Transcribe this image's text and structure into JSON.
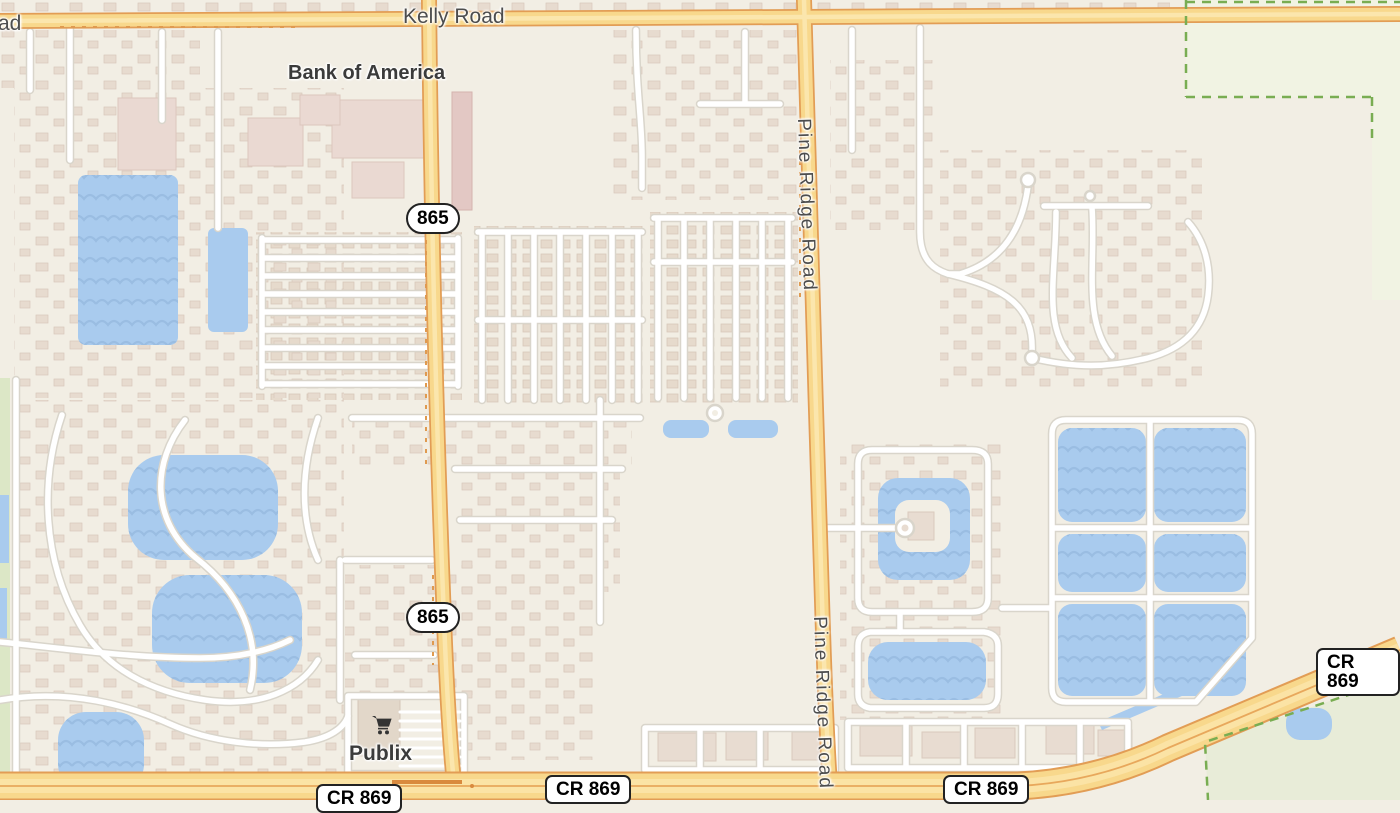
{
  "map": {
    "type": "street-map",
    "road_labels": {
      "kelly_road": "Kelly Road",
      "left_edge_partial": "ad",
      "pine_ridge_road": "Pine Ridge Road"
    },
    "route_shields": {
      "sr_865": "865",
      "cr_869": "CR 869"
    },
    "pois": {
      "bank_of_america": "Bank of America",
      "publix": "Publix",
      "publix_icon": "shopping-cart-icon"
    },
    "colors": {
      "background": "#f2eee4",
      "major_road_fill": "#f8d88c",
      "major_road_casing": "#e29d55",
      "minor_road_fill": "#ffffff",
      "minor_road_casing": "#d9d5cb",
      "water": "#a9cbee",
      "water_wave": "#9abde2",
      "building": "#e8dcd1",
      "park_boundary": "#79ad52",
      "park_fill": "#e8ecd8",
      "label_text": "#474747",
      "shield_border": "#222222",
      "shield_background": "#ffffff"
    }
  }
}
